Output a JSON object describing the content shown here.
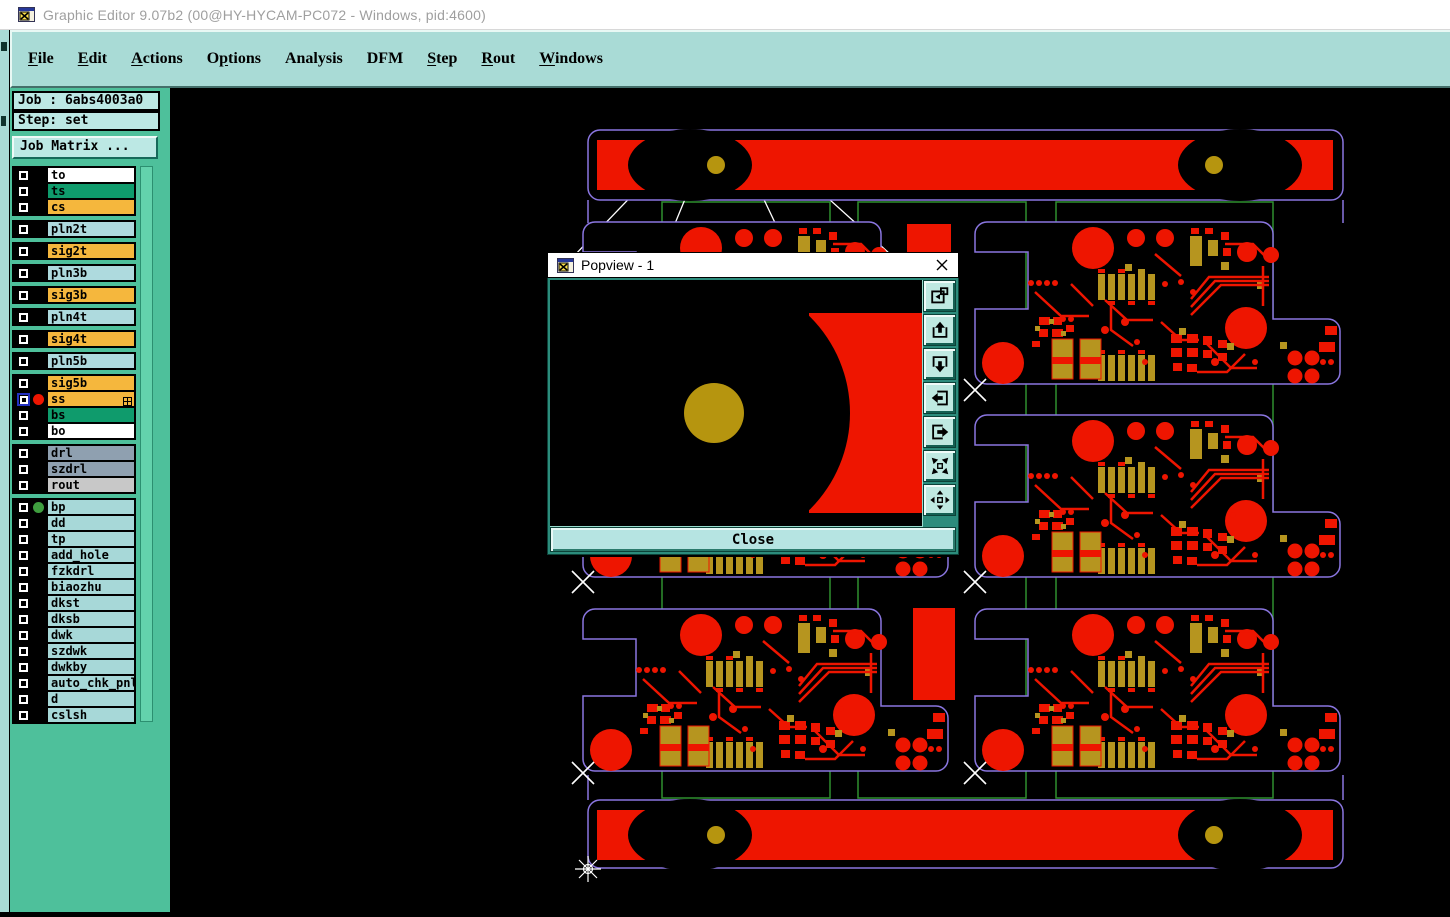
{
  "window": {
    "title": "Graphic Editor 9.07b2 (00@HY-HYCAM-PC072 - Windows, pid:4600)",
    "icon": "app-window-icon"
  },
  "menu": {
    "items": [
      {
        "label": "File",
        "underline": 0
      },
      {
        "label": "Edit",
        "underline": 0
      },
      {
        "label": "Actions",
        "underline": 0
      },
      {
        "label": "Options",
        "underline": 1
      },
      {
        "label": "Analysis",
        "underline": -1
      },
      {
        "label": "DFM",
        "underline": -1
      },
      {
        "label": "Step",
        "underline": 0
      },
      {
        "label": "Rout",
        "underline": 0
      },
      {
        "label": "Windows",
        "underline": 0
      }
    ]
  },
  "sidebar": {
    "job_label": "Job : 6abs4003a0",
    "step_label": "Step: set",
    "job_matrix_button": "Job Matrix ...",
    "layer_groups": [
      {
        "layers": [
          {
            "name": "to",
            "color": "#ffffff"
          },
          {
            "name": "ts",
            "color": "#0f9b6c"
          },
          {
            "name": "cs",
            "color": "#f5b73d"
          }
        ]
      },
      {
        "layers": [
          {
            "name": "pln2t",
            "color": "#aedade"
          }
        ]
      },
      {
        "layers": [
          {
            "name": "sig2t",
            "color": "#f5b73d"
          }
        ]
      },
      {
        "layers": [
          {
            "name": "pln3b",
            "color": "#aedade"
          }
        ]
      },
      {
        "layers": [
          {
            "name": "sig3b",
            "color": "#f5b73d"
          }
        ]
      },
      {
        "layers": [
          {
            "name": "pln4t",
            "color": "#aedade"
          }
        ]
      },
      {
        "layers": [
          {
            "name": "sig4t",
            "color": "#f5b73d"
          }
        ]
      },
      {
        "layers": [
          {
            "name": "pln5b",
            "color": "#aedade"
          }
        ]
      },
      {
        "layers": [
          {
            "name": "sig5b",
            "color": "#f5b73d"
          },
          {
            "name": "ss",
            "color": "#f5b73d",
            "active": true,
            "dot": "#ee1500",
            "badge": true
          },
          {
            "name": "bs",
            "color": "#0f9b6c"
          },
          {
            "name": "bo",
            "color": "#ffffff"
          }
        ]
      },
      {
        "layers": [
          {
            "name": "drl",
            "color": "#8fa0b0"
          },
          {
            "name": "szdrl",
            "color": "#8fa0b0"
          },
          {
            "name": "rout",
            "color": "#c8c8c8"
          }
        ]
      },
      {
        "layers": [
          {
            "name": "bp",
            "color": "#a7d8d8",
            "dot": "#3f9e3f"
          },
          {
            "name": "dd",
            "color": "#a7d8d8"
          },
          {
            "name": "tp",
            "color": "#a7d8d8"
          },
          {
            "name": "add_hole",
            "color": "#a7d8d8"
          },
          {
            "name": "fzkdrl",
            "color": "#a7d8d8"
          },
          {
            "name": "biaozhu",
            "color": "#a7d8d8"
          },
          {
            "name": "dkst",
            "color": "#a7d8d8"
          },
          {
            "name": "dksb",
            "color": "#a7d8d8"
          },
          {
            "name": "dwk",
            "color": "#a7d8d8"
          },
          {
            "name": "szdwk",
            "color": "#a7d8d8"
          },
          {
            "name": "dwkby",
            "color": "#a7d8d8"
          },
          {
            "name": "auto_chk_pnl",
            "color": "#a7d8d8"
          },
          {
            "name": "d",
            "color": "#a7d8d8"
          },
          {
            "name": "cslsh",
            "color": "#a7d8d8"
          }
        ]
      }
    ]
  },
  "popview": {
    "title": "Popview - 1",
    "close_label": "Close",
    "buttons": [
      {
        "name": "popout-window-button",
        "icon": "window-copy-icon"
      },
      {
        "name": "pan-up-button",
        "icon": "arrow-up-icon"
      },
      {
        "name": "pan-down-button",
        "icon": "arrow-down-icon"
      },
      {
        "name": "pan-left-button",
        "icon": "arrow-left-icon"
      },
      {
        "name": "pan-right-button",
        "icon": "arrow-right-icon"
      },
      {
        "name": "zoom-fit-button",
        "icon": "arrows-in-icon"
      },
      {
        "name": "pan-center-button",
        "icon": "arrows-out-icon"
      }
    ]
  },
  "colors": {
    "pcb_red": "#ee1500",
    "pcb_gold": "#b6950f",
    "outline_purple": "#8a76e0",
    "panel_green": "#2f8f2f",
    "sidebar_teal": "#4ec09b",
    "menubar_teal": "#a9dbd6",
    "pale_cyan": "#bce8e4",
    "canvas_black": "#000000"
  }
}
